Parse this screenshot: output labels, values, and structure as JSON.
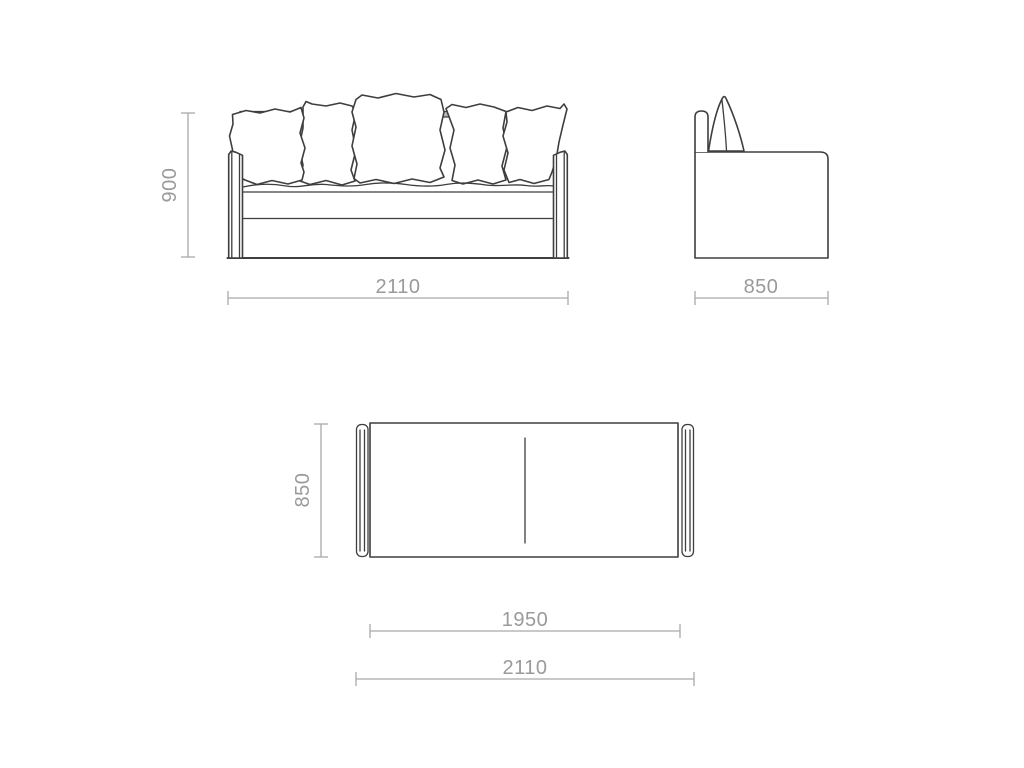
{
  "colors": {
    "background": "#ffffff",
    "outline": "#3e3e3e",
    "dimension": "#a9a9a9",
    "text": "#9a9a9a"
  },
  "front_view": {
    "height_label": "900",
    "width_label": "2110"
  },
  "side_view": {
    "depth_label": "850"
  },
  "plan_view": {
    "depth_label": "850",
    "inner_width_label": "1950",
    "overall_width_label": "2110"
  }
}
